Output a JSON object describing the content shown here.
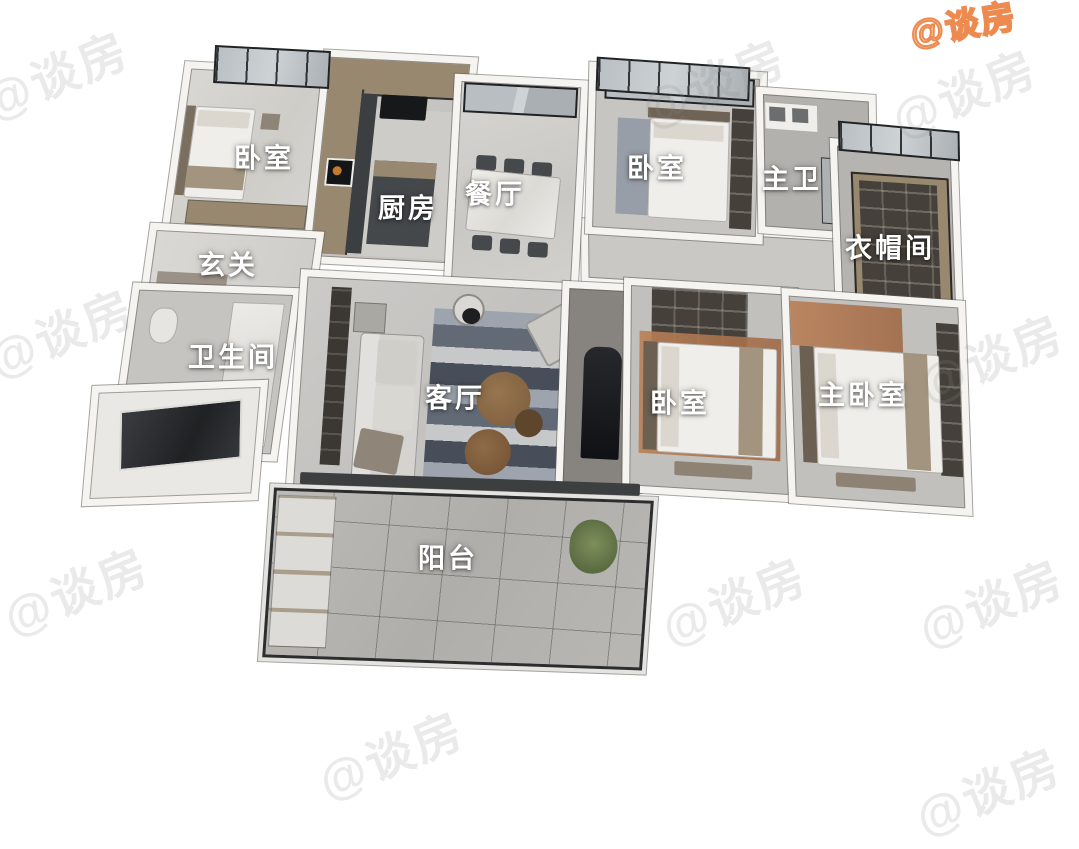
{
  "watermark": {
    "text": "@谈房",
    "orange_color": "#ed8a4f",
    "gray_color": "#8c8c8c"
  },
  "palette": {
    "background": "#ffffff",
    "wall_white": "#f5f4f1",
    "floor_gray": "#c6c4c0",
    "cabinet_charcoal": "#3c3f42",
    "wood_tone": "#97886f",
    "rug_terracotta": "#b97f57",
    "plant_green": "#6f7f52"
  },
  "rooms": {
    "bedroom_top_left": {
      "label": "卧室"
    },
    "kitchen": {
      "label": "厨房"
    },
    "dining": {
      "label": "餐厅"
    },
    "bedroom_top_right": {
      "label": "卧室"
    },
    "master_bath": {
      "label": "主卫"
    },
    "closet": {
      "label": "衣帽间"
    },
    "entry": {
      "label": "玄关"
    },
    "bathroom": {
      "label": "卫生间"
    },
    "living": {
      "label": "客厅"
    },
    "bedroom_right": {
      "label": "卧室"
    },
    "master_bedroom": {
      "label": "主卧室"
    },
    "balcony": {
      "label": "阳台"
    }
  }
}
